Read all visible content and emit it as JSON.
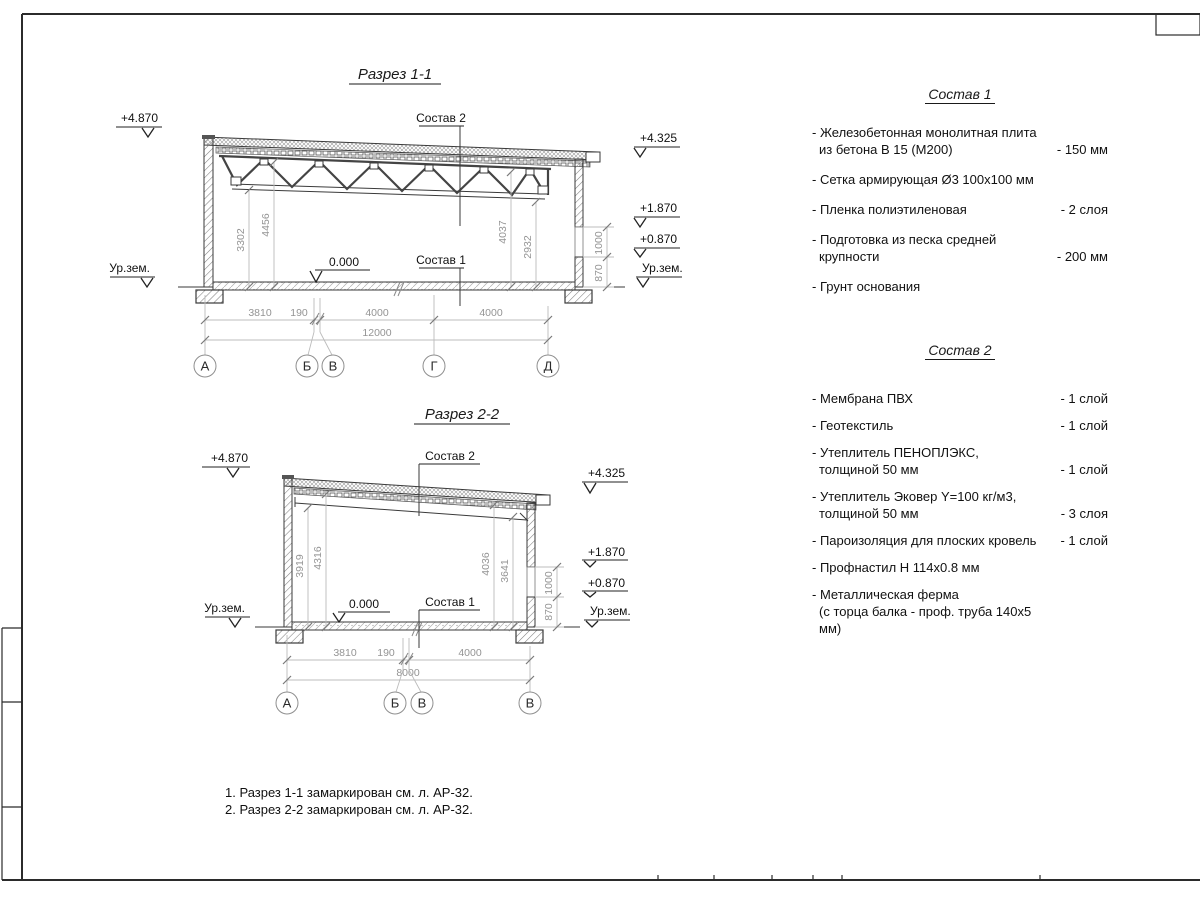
{
  "sections": {
    "s1": {
      "title": "Разрез 1-1",
      "labels": {
        "sostav2": "Состав 2",
        "sostav1": "Состав 1",
        "zero": "0.000"
      },
      "elev": {
        "l_top": "+4.870",
        "l_ground": "Ур.зем.",
        "r_top": "+4.325",
        "r_187": "+1.870",
        "r_087": "+0.870",
        "r_ground": "Ур.зем."
      },
      "vdim": {
        "a": "3302",
        "b": "4456",
        "c": "4037",
        "d": "2932",
        "w_low": "870",
        "w_high": "1000"
      },
      "hdim": {
        "d1": "3810",
        "d2": "190",
        "d3": "4000",
        "d4": "4000",
        "total": "12000"
      },
      "axes": [
        "А",
        "Б",
        "В",
        "Г",
        "Д"
      ]
    },
    "s2": {
      "title": "Разрез 2-2",
      "labels": {
        "sostav2": "Состав 2",
        "sostav1": "Состав 1",
        "zero": "0.000"
      },
      "elev": {
        "l_top": "+4.870",
        "l_ground": "Ур.зем.",
        "r_top": "+4.325",
        "r_187": "+1.870",
        "r_087": "+0.870",
        "r_ground": "Ур.зем."
      },
      "vdim": {
        "a": "3919",
        "b": "4316",
        "c": "4036",
        "d": "3641",
        "w_low": "870",
        "w_high": "1000"
      },
      "hdim": {
        "d1": "3810",
        "d2": "190",
        "d3": "4000",
        "total": "8000"
      },
      "axes": [
        "А",
        "Б",
        "В",
        "В"
      ]
    }
  },
  "lists": {
    "sostav1": {
      "title": "Состав 1",
      "items": [
        {
          "line1": "- Железобетонная монолитная плита",
          "line2": "из бетона В 15 (М200)",
          "value": "- 150 мм"
        },
        {
          "line1": "- Сетка армирующая Ø3 100х100 мм",
          "line2": "",
          "value": ""
        },
        {
          "line1": "- Пленка полиэтиленовая",
          "line2": "",
          "value": "- 2 слоя"
        },
        {
          "line1": "- Подготовка из песка средней",
          "line2": "крупности",
          "value": "- 200 мм"
        },
        {
          "line1": "- Грунт основания",
          "line2": "",
          "value": ""
        }
      ]
    },
    "sostav2": {
      "title": "Состав 2",
      "items": [
        {
          "line1": "- Мембрана ПВХ",
          "line2": "",
          "value": "- 1 слой"
        },
        {
          "line1": "- Геотекстиль",
          "line2": "",
          "value": "- 1 слой"
        },
        {
          "line1": "- Утеплитель ПЕНОПЛЭКС,",
          "line2": "толщиной 50 мм",
          "value": "- 1 слой"
        },
        {
          "line1": "- Утеплитель Эковер Y=100 кг/м3,",
          "line2": "толщиной 50 мм",
          "value": "- 3 слоя"
        },
        {
          "line1": "- Пароизоляция для плоских кровель",
          "line2": "",
          "value": "- 1 слой"
        },
        {
          "line1": "- Профнастил Н 114х0.8 мм",
          "line2": "",
          "value": ""
        },
        {
          "line1": "- Металлическая ферма",
          "line2": "(с торца балка - проф. труба 140х5 мм)",
          "value": ""
        }
      ]
    }
  },
  "notes": {
    "n1": "1. Разрез 1-1 замаркирован см. л. АР-32.",
    "n2": "2. Разрез 2-2 замаркирован см. л. АР-32."
  }
}
